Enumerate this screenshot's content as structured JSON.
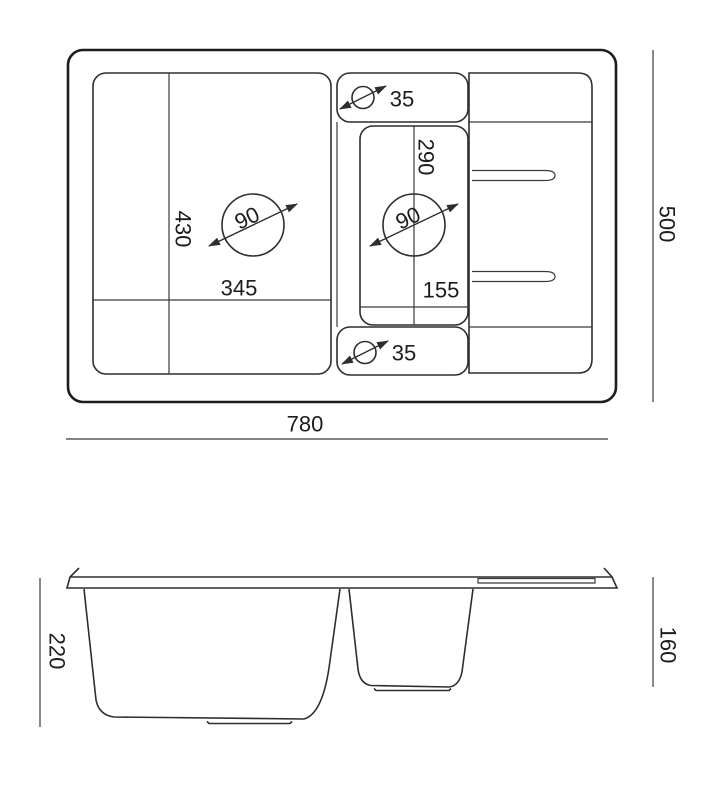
{
  "drawing": {
    "subject": "kitchen-sink-technical-drawing",
    "colors": {
      "background": "#ffffff",
      "line": "#2e2e2e",
      "outline": "#1d1d1d",
      "text": "#1c1c1c"
    },
    "top_view": {
      "overall_width": "780",
      "overall_depth": "500",
      "main_bowl_width": "345",
      "main_bowl_depth": "430",
      "main_bowl_drain_diameter": "90",
      "half_bowl_width": "155",
      "half_bowl_depth": "290",
      "half_bowl_drain_diameter": "90",
      "tap_hole_top_diameter": "35",
      "tap_hole_bottom_diameter": "35"
    },
    "side_view": {
      "main_bowl_depth": "220",
      "half_bowl_depth": "160"
    }
  }
}
